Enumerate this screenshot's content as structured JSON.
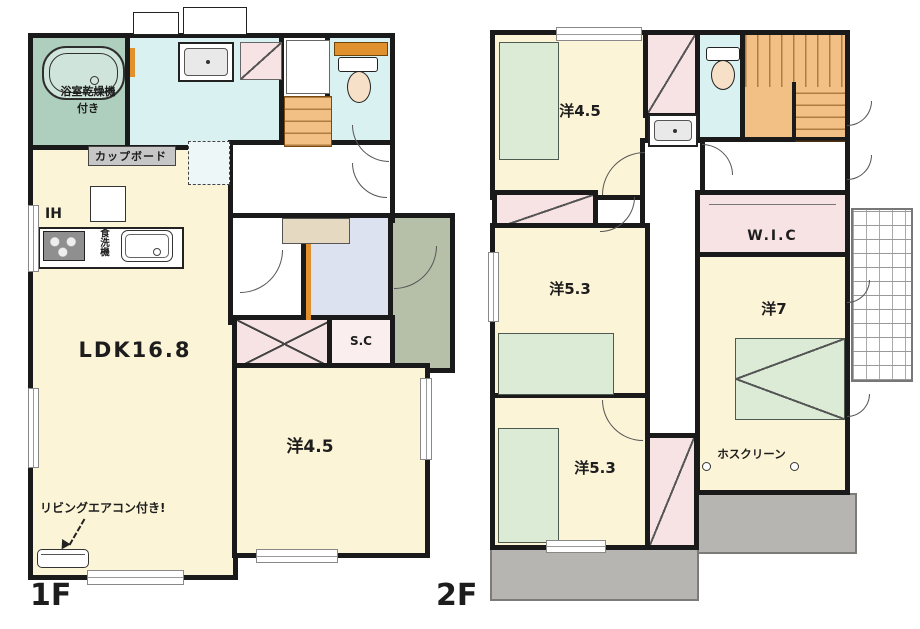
{
  "colors": {
    "wall": "#1a1a1a",
    "room_cream": "#fcf4d6",
    "water_cyan": "#d9f1f0",
    "closet_pink": "#f7e3e3",
    "bath_green": "#aecfbd",
    "bed_green": "#dcebd6",
    "stairs_orange": "#f2bf85",
    "balcony_gray": "#b7b5b1",
    "porch_tile_green": "#b6c0a8",
    "entrance_tile_lavender": "#dde2f1",
    "cabinet_beige": "#e6d9c1",
    "accent_orange": "#e0912e"
  },
  "floors": {
    "f1": {
      "floor_label": "1F",
      "labels": {
        "bath_note": "浴室乾燥機付き",
        "cupboard": "カップボード",
        "ih": "IH",
        "dishwasher": "食洗機",
        "ldk": "LDK16.8",
        "aircon_note": "リビングエアコン付き!",
        "shoe_closet": "S.C",
        "western_45": "洋4.5"
      }
    },
    "f2": {
      "floor_label": "2F",
      "labels": {
        "western_45": "洋4.5",
        "western_53_middle": "洋5.3",
        "walk_in_closet": "W.I.C",
        "western_7": "洋7",
        "western_53_bottom": "洋5.3",
        "hoscreen": "ホスクリーン"
      }
    }
  }
}
